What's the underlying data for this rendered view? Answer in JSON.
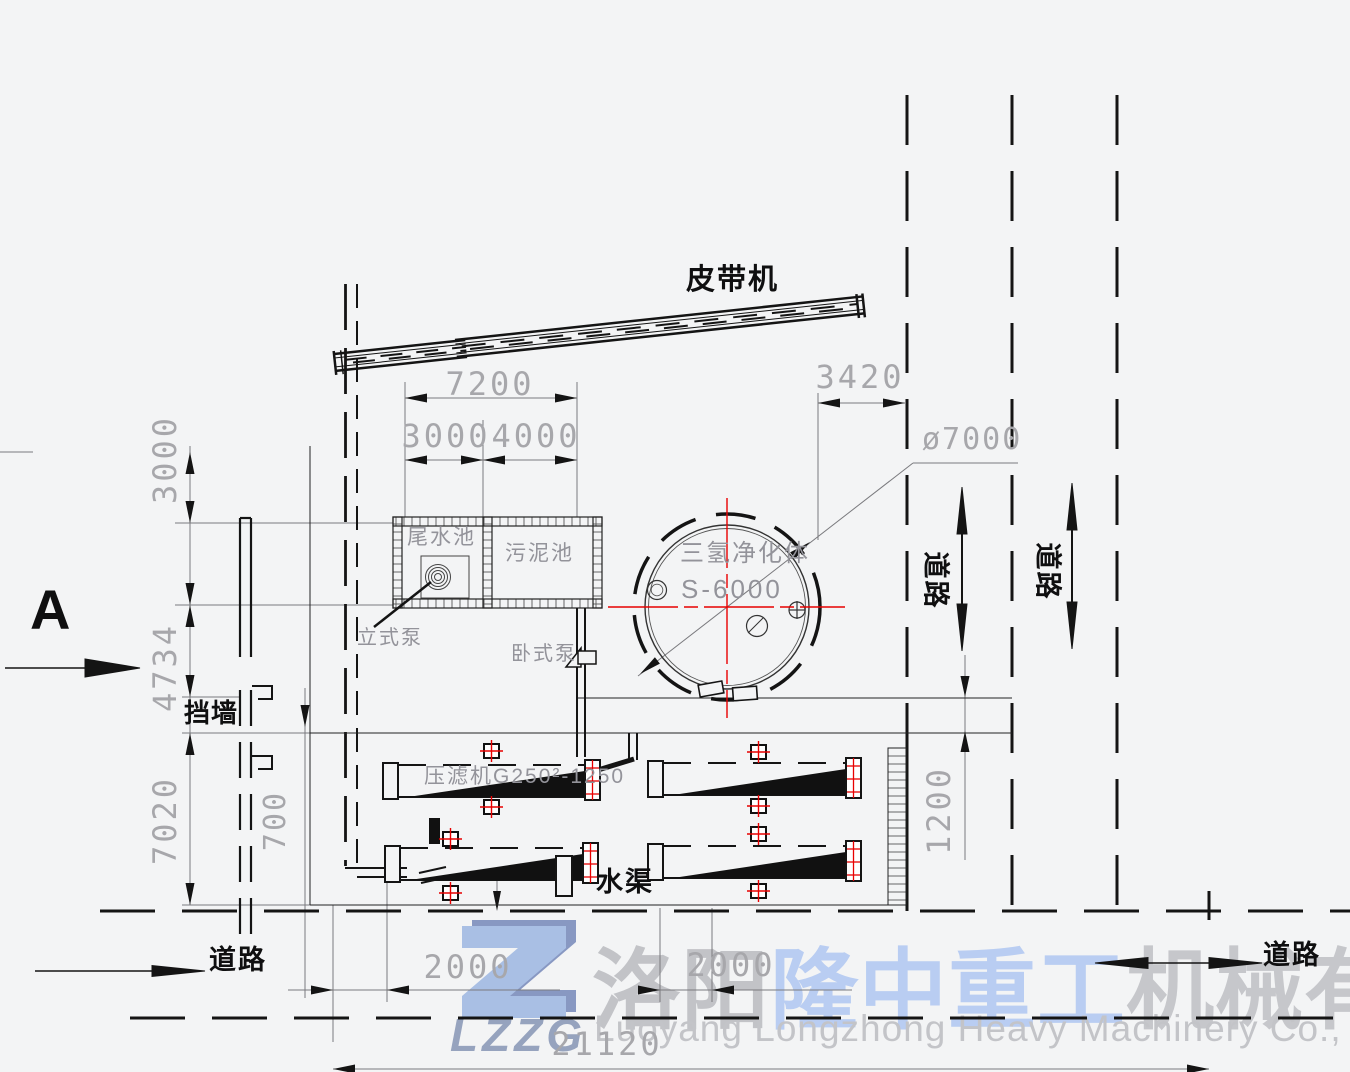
{
  "labels": {
    "belt_conveyor": "皮带机",
    "section_a": "A",
    "retaining_wall": "挡墙",
    "water_channel": "水渠",
    "road": "道路",
    "tail_water_pool": "尾水池",
    "sludge_pool": "污泥池",
    "vertical_pump": "立式泵",
    "horizontal_pump": "卧式泵",
    "purifier_name": "三氢净化体",
    "purifier_model": "S-6000",
    "filter_press": "压滤机G250²-1250"
  },
  "dimensions": {
    "top_total": "7200",
    "top_left": "3000",
    "top_right": "4000",
    "right_offset": "3420",
    "tank_diameter": "ø7000",
    "left_top": "3000",
    "left_mid": "4734",
    "left_bottom": "7020",
    "wall_offset": "700",
    "channel_width": "1200",
    "bottom_left": "2000",
    "bottom_mid": "2000",
    "bottom_total": "21120"
  },
  "watermark": {
    "logo_text": "LZZG",
    "company_cn_1": "洛阳",
    "company_cn_2": "隆中重工",
    "company_cn_3": "机械有限公司",
    "company_en": "Luoyang Longzhong Heavy Machinery Co., Ltd."
  },
  "colors": {
    "centerline_red": "#e80000",
    "watermark_blue": "#b9cdf2",
    "watermark_gray": "#c6c7cb",
    "logo_blue": "#a9bfe4",
    "logo_shadow": "#8898c2"
  }
}
